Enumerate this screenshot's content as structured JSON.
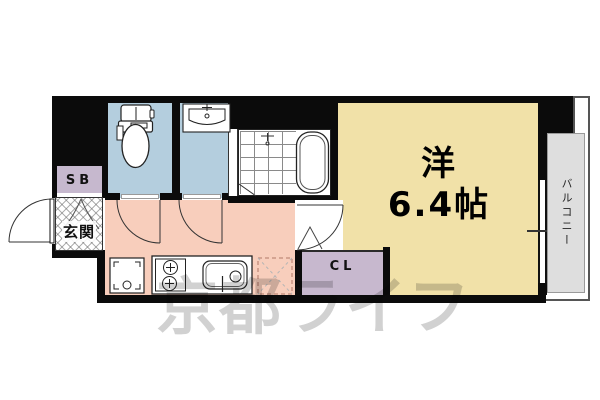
{
  "plan": {
    "entrance_label": "玄関",
    "shoebox_label": "SB",
    "closet_label": "CL",
    "balcony_label": "バルコニー",
    "main_room_name": "洋",
    "main_room_size": "6.4帖",
    "watermark_text": "京都ライフ",
    "colors": {
      "wall": "#0b0b0b",
      "wet_rooms": "#b4cede",
      "main_room": "#f1e1a8",
      "kitchen": "#f8cebc",
      "closet": "#c7b8ce",
      "shoebox": "#c6b8ce",
      "balcony": "#dedede",
      "watermark": "#c9c9c9"
    }
  }
}
